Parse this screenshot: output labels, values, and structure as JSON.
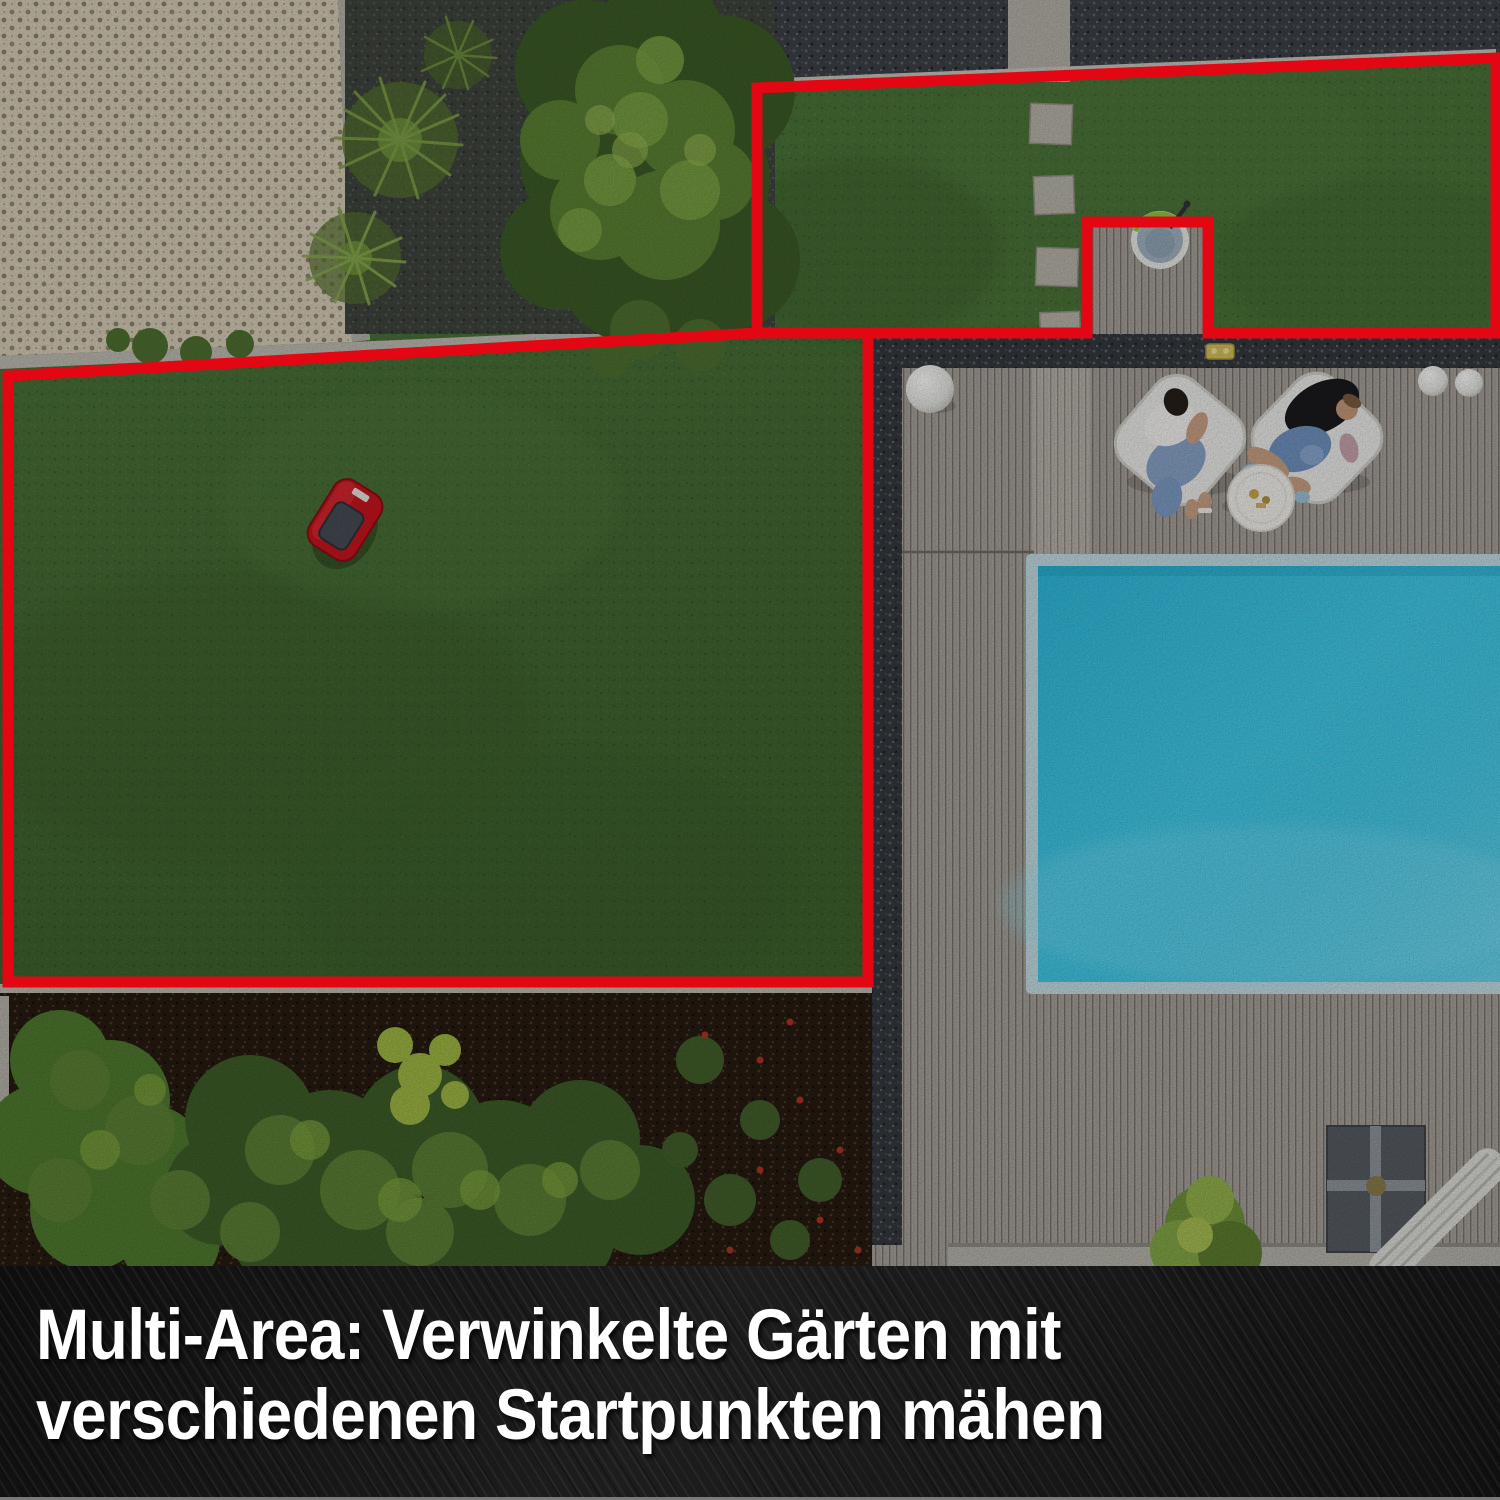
{
  "caption": {
    "line1": "Multi-Area: Verwinkelte Gärten mit",
    "line2": "verschiedenen Startpunkten mähen"
  },
  "colors": {
    "boundary_red": "#e30613",
    "lawn_green": "#4a7338",
    "pool_water": "#41c9e8",
    "pool_coping": "#c3dde4",
    "deck_wood": "#a8a29b",
    "gravel_dark": "#3c4046",
    "paver_beige": "#d6cdb8",
    "curb_gray": "#bdbbb2",
    "mulch_brown": "#261b11",
    "mower_red": "#c8151f",
    "caption_bg": "#141414",
    "caption_text": "#ffffff"
  }
}
